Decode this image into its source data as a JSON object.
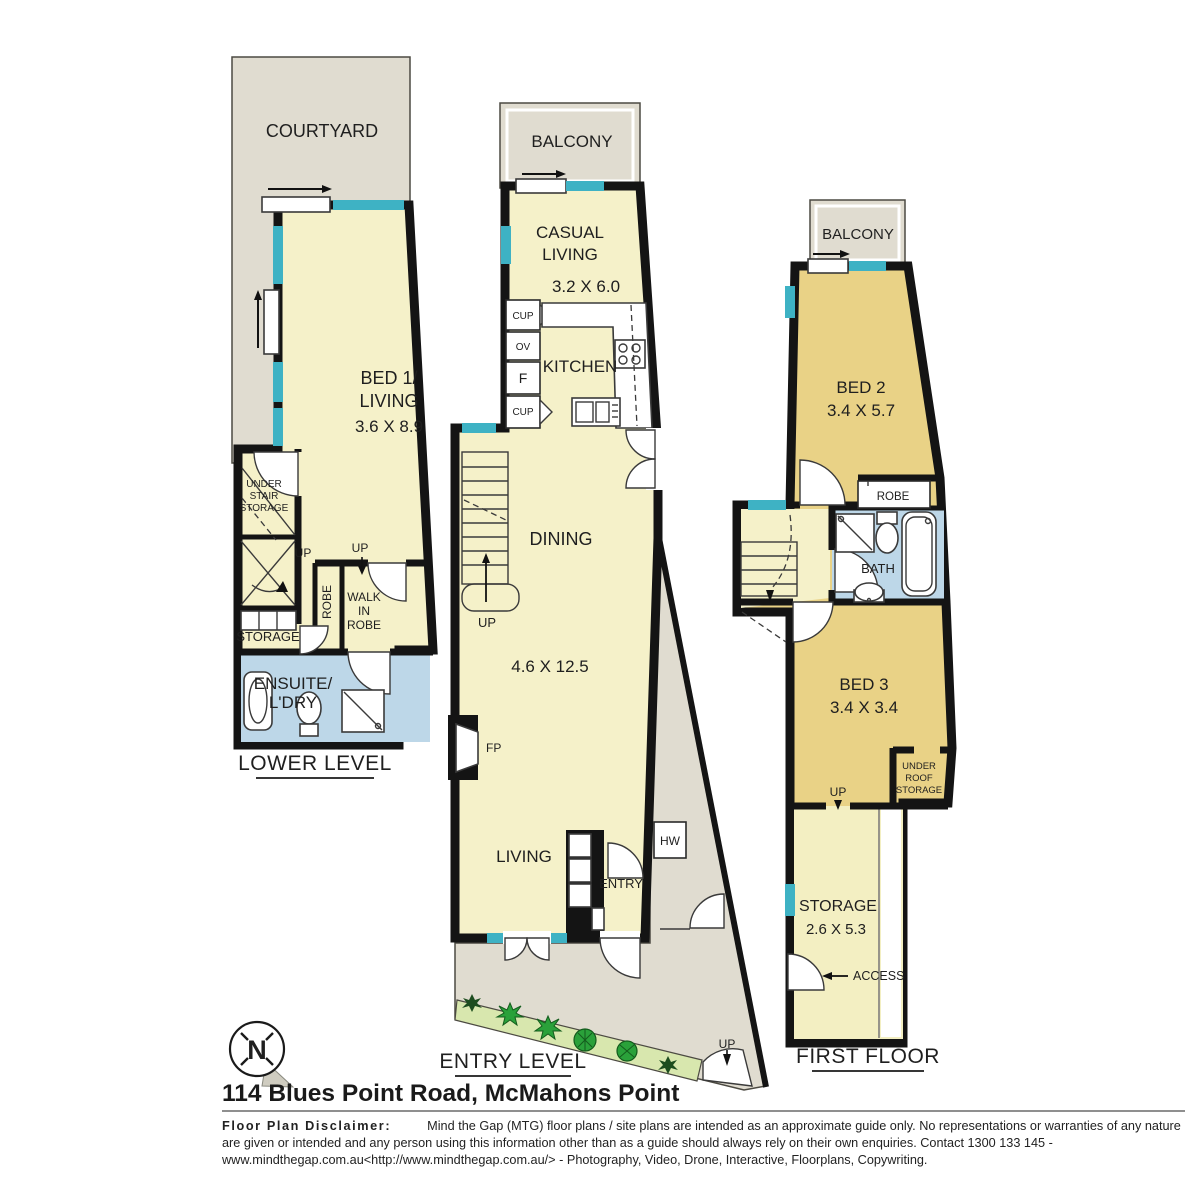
{
  "compass": {
    "north": "N"
  },
  "lower": {
    "title": "LOWER LEVEL",
    "courtyard": "COURTYARD",
    "bed1_l1": "BED 1/",
    "bed1_l2": "LIVING",
    "bed1_dim": "3.6 X 8.9",
    "uss_l1": "UNDER",
    "uss_l2": "STAIR",
    "uss_l3": "STORAGE",
    "up_a": "UP",
    "up_b": "UP",
    "robe": "ROBE",
    "wir_l1": "WALK",
    "wir_l2": "IN",
    "wir_l3": "ROBE",
    "storage": "STORAGE",
    "ensuite_l1": "ENSUITE/",
    "ensuite_l2": "L'DRY"
  },
  "entry": {
    "title": "ENTRY LEVEL",
    "balcony": "BALCONY",
    "casual_l1": "CASUAL",
    "casual_l2": "LIVING",
    "casual_dim": "3.2 X 6.0",
    "kitchen": "KITCHEN",
    "cup_top": "CUP",
    "oven": "OV",
    "fridge": "F",
    "cup_bottom": "CUP",
    "dining": "DINING",
    "dining_dim": "4.6 X 12.5",
    "up_stairs": "UP",
    "fp": "FP",
    "living": "LIVING",
    "entry": "ENTRY",
    "hw": "HW",
    "up_path": "UP"
  },
  "first": {
    "title": "FIRST FLOOR",
    "balcony": "BALCONY",
    "bed2": "BED 2",
    "bed2_dim": "3.4 X 5.7",
    "robe": "ROBE",
    "bath": "BATH",
    "bed3": "BED 3",
    "bed3_dim": "3.4 X 3.4",
    "urs_l1": "UNDER",
    "urs_l2": "ROOF",
    "urs_l3": "STORAGE",
    "up": "UP",
    "storage": "STORAGE",
    "storage_dim": "2.6 X 5.3",
    "access": "ACCESS"
  },
  "footer": {
    "address": "114 Blues Point Road, McMahons Point",
    "disclaimer_label": "Floor Plan Disclaimer:",
    "disclaimer_text": "Mind the Gap (MTG) floor plans / site plans are intended as an approximate guide only. No representations or warranties of any nature are given or intended and any person using this information other than as a guide should always rely on their own enquiries. Contact 1300 133 145 - www.mindthegap.com.au<http://www.mindthegap.com.au/> - Photography, Video, Drone, Interactive, Floorplans, Copywriting."
  },
  "colors": {
    "wall": "#141414",
    "room_cream": "#f5f1c9",
    "room_tan": "#e9d286",
    "outdoor_grey": "#e0dcd0",
    "bath_blue": "#bdd7e8",
    "window_teal": "#3eb2c4",
    "garden_green": "#d8e7ae",
    "plant_green": "#2aa13a"
  }
}
